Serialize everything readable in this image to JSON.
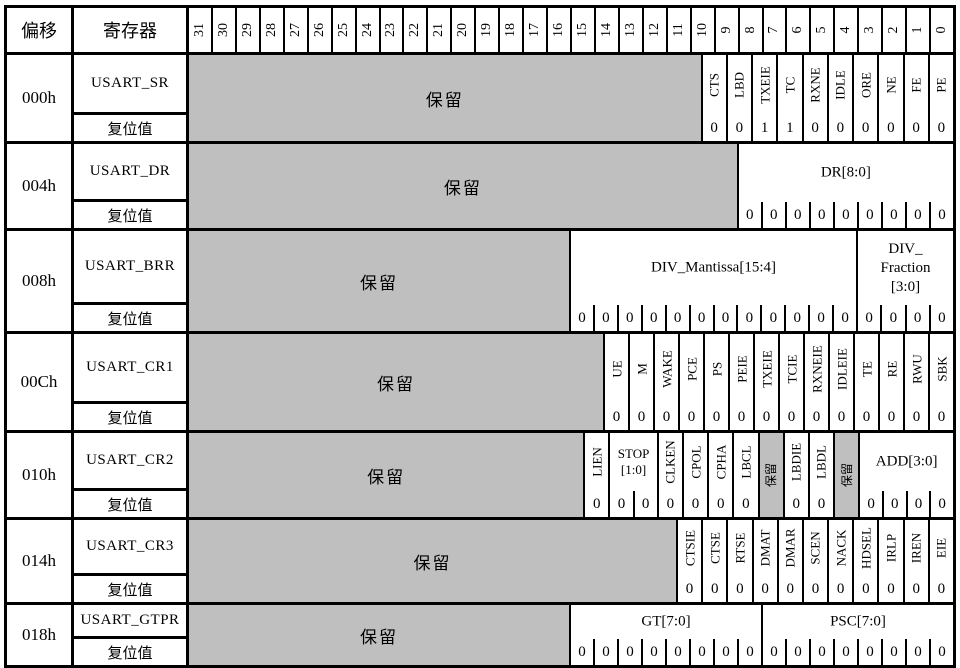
{
  "header": {
    "offset_label": "偏移",
    "register_label": "寄存器",
    "bit_numbers": [
      "31",
      "30",
      "29",
      "28",
      "27",
      "26",
      "25",
      "24",
      "23",
      "22",
      "21",
      "20",
      "19",
      "18",
      "17",
      "16",
      "15",
      "14",
      "13",
      "12",
      "11",
      "10",
      "9",
      "8",
      "7",
      "6",
      "5",
      "4",
      "3",
      "2",
      "1",
      "0"
    ]
  },
  "labels": {
    "reset": "复位值",
    "reserved": "保留"
  },
  "colors": {
    "reserved_bg": "#bfbfbf",
    "border": "#000000",
    "background": "#ffffff"
  },
  "rows": [
    {
      "offset": "000h",
      "name": "USART_SR",
      "height": 86,
      "fields": [
        {
          "kind": "reserved",
          "span": 22
        },
        {
          "kind": "v",
          "span": 1,
          "label": "CTS",
          "reset": [
            "0"
          ]
        },
        {
          "kind": "v",
          "span": 1,
          "label": "LBD",
          "reset": [
            "0"
          ]
        },
        {
          "kind": "v",
          "span": 1,
          "label": "TXEIE",
          "reset": [
            "1"
          ]
        },
        {
          "kind": "v",
          "span": 1,
          "label": "TC",
          "reset": [
            "1"
          ]
        },
        {
          "kind": "v",
          "span": 1,
          "label": "RXNE",
          "reset": [
            "0"
          ]
        },
        {
          "kind": "v",
          "span": 1,
          "label": "IDLE",
          "reset": [
            "0"
          ]
        },
        {
          "kind": "v",
          "span": 1,
          "label": "ORE",
          "reset": [
            "0"
          ]
        },
        {
          "kind": "v",
          "span": 1,
          "label": "NE",
          "reset": [
            "0"
          ]
        },
        {
          "kind": "v",
          "span": 1,
          "label": "FE",
          "reset": [
            "0"
          ]
        },
        {
          "kind": "v",
          "span": 1,
          "label": "PE",
          "reset": [
            "0"
          ]
        }
      ]
    },
    {
      "offset": "004h",
      "name": "USART_DR",
      "height": 84,
      "fields": [
        {
          "kind": "reserved",
          "span": 23
        },
        {
          "kind": "h",
          "span": 9,
          "label": "DR[8:0]",
          "reset": [
            "0",
            "0",
            "0",
            "0",
            "0",
            "0",
            "0",
            "0",
            "0"
          ]
        }
      ]
    },
    {
      "offset": "008h",
      "name": "USART_BRR",
      "height": 100,
      "fields": [
        {
          "kind": "reserved",
          "span": 16
        },
        {
          "kind": "h",
          "span": 12,
          "label": "DIV_Mantissa[15:4]",
          "reset": [
            "0",
            "0",
            "0",
            "0",
            "0",
            "0",
            "0",
            "0",
            "0",
            "0",
            "0",
            "0"
          ]
        },
        {
          "kind": "h",
          "span": 4,
          "label": "DIV_\nFraction\n[3:0]",
          "reset": [
            "0",
            "0",
            "0",
            "0"
          ]
        }
      ]
    },
    {
      "offset": "00Ch",
      "name": "USART_CR1",
      "height": 96,
      "fields": [
        {
          "kind": "reserved",
          "span": 18
        },
        {
          "kind": "v",
          "span": 1,
          "label": "UE",
          "reset": [
            "0"
          ]
        },
        {
          "kind": "v",
          "span": 1,
          "label": "M",
          "reset": [
            "0"
          ]
        },
        {
          "kind": "v",
          "span": 1,
          "label": "WAKE",
          "reset": [
            "0"
          ]
        },
        {
          "kind": "v",
          "span": 1,
          "label": "PCE",
          "reset": [
            "0"
          ]
        },
        {
          "kind": "v",
          "span": 1,
          "label": "PS",
          "reset": [
            "0"
          ]
        },
        {
          "kind": "v",
          "span": 1,
          "label": "PEIE",
          "reset": [
            "0"
          ]
        },
        {
          "kind": "v",
          "span": 1,
          "label": "TXEIE",
          "reset": [
            "0"
          ]
        },
        {
          "kind": "v",
          "span": 1,
          "label": "TCIE",
          "reset": [
            "0"
          ]
        },
        {
          "kind": "v",
          "span": 1,
          "label": "RXNEIE",
          "reset": [
            "0"
          ]
        },
        {
          "kind": "v",
          "span": 1,
          "label": "IDLEIE",
          "reset": [
            "0"
          ]
        },
        {
          "kind": "v",
          "span": 1,
          "label": "TE",
          "reset": [
            "0"
          ]
        },
        {
          "kind": "v",
          "span": 1,
          "label": "RE",
          "reset": [
            "0"
          ]
        },
        {
          "kind": "v",
          "span": 1,
          "label": "RWU",
          "reset": [
            "0"
          ]
        },
        {
          "kind": "v",
          "span": 1,
          "label": "SBK",
          "reset": [
            "0"
          ]
        }
      ]
    },
    {
      "offset": "010h",
      "name": "USART_CR2",
      "height": 84,
      "fields": [
        {
          "kind": "reserved",
          "span": 17
        },
        {
          "kind": "v",
          "span": 1,
          "label": "LIEN",
          "reset": [
            "0"
          ]
        },
        {
          "kind": "h",
          "span": 2,
          "label": "STOP\n[1:0]",
          "small": true,
          "reset": [
            "0",
            "0"
          ]
        },
        {
          "kind": "v",
          "span": 1,
          "label": "CLKEN",
          "reset": [
            "0"
          ]
        },
        {
          "kind": "v",
          "span": 1,
          "label": "CPOL",
          "reset": [
            "0"
          ]
        },
        {
          "kind": "v",
          "span": 1,
          "label": "CPHA",
          "reset": [
            "0"
          ]
        },
        {
          "kind": "v",
          "span": 1,
          "label": "LBCL",
          "reset": [
            "0"
          ]
        },
        {
          "kind": "reserved-v",
          "span": 1
        },
        {
          "kind": "v",
          "span": 1,
          "label": "LBDIE",
          "reset": [
            "0"
          ]
        },
        {
          "kind": "v",
          "span": 1,
          "label": "LBDL",
          "reset": [
            "0"
          ]
        },
        {
          "kind": "reserved-v",
          "span": 1
        },
        {
          "kind": "h",
          "span": 4,
          "label": "ADD[3:0]",
          "reset": [
            "0",
            "0",
            "0",
            "0"
          ]
        }
      ]
    },
    {
      "offset": "014h",
      "name": "USART_CR3",
      "height": 82,
      "fields": [
        {
          "kind": "reserved",
          "span": 21
        },
        {
          "kind": "v",
          "span": 1,
          "label": "CTSIE",
          "reset": [
            "0"
          ]
        },
        {
          "kind": "v",
          "span": 1,
          "label": "CTSE",
          "reset": [
            "0"
          ]
        },
        {
          "kind": "v",
          "span": 1,
          "label": "RTSE",
          "reset": [
            "0"
          ]
        },
        {
          "kind": "v",
          "span": 1,
          "label": "DMAT",
          "reset": [
            "0"
          ]
        },
        {
          "kind": "v",
          "span": 1,
          "label": "DMAR",
          "reset": [
            "0"
          ]
        },
        {
          "kind": "v",
          "span": 1,
          "label": "SCEN",
          "reset": [
            "0"
          ]
        },
        {
          "kind": "v",
          "span": 1,
          "label": "NACK",
          "reset": [
            "0"
          ]
        },
        {
          "kind": "v",
          "span": 1,
          "label": "HDSEL",
          "reset": [
            "0"
          ]
        },
        {
          "kind": "v",
          "span": 1,
          "label": "IRLP",
          "reset": [
            "0"
          ]
        },
        {
          "kind": "v",
          "span": 1,
          "label": "IREN",
          "reset": [
            "0"
          ]
        },
        {
          "kind": "v",
          "span": 1,
          "label": "EIE",
          "reset": [
            "0"
          ]
        }
      ]
    },
    {
      "offset": "018h",
      "name": "USART_GTPR",
      "height": 60,
      "fields": [
        {
          "kind": "reserved",
          "span": 16
        },
        {
          "kind": "h",
          "span": 8,
          "label": "GT[7:0]",
          "reset": [
            "0",
            "0",
            "0",
            "0",
            "0",
            "0",
            "0",
            "0"
          ]
        },
        {
          "kind": "h",
          "span": 8,
          "label": "PSC[7:0]",
          "reset": [
            "0",
            "0",
            "0",
            "0",
            "0",
            "0",
            "0",
            "0"
          ]
        }
      ]
    }
  ]
}
